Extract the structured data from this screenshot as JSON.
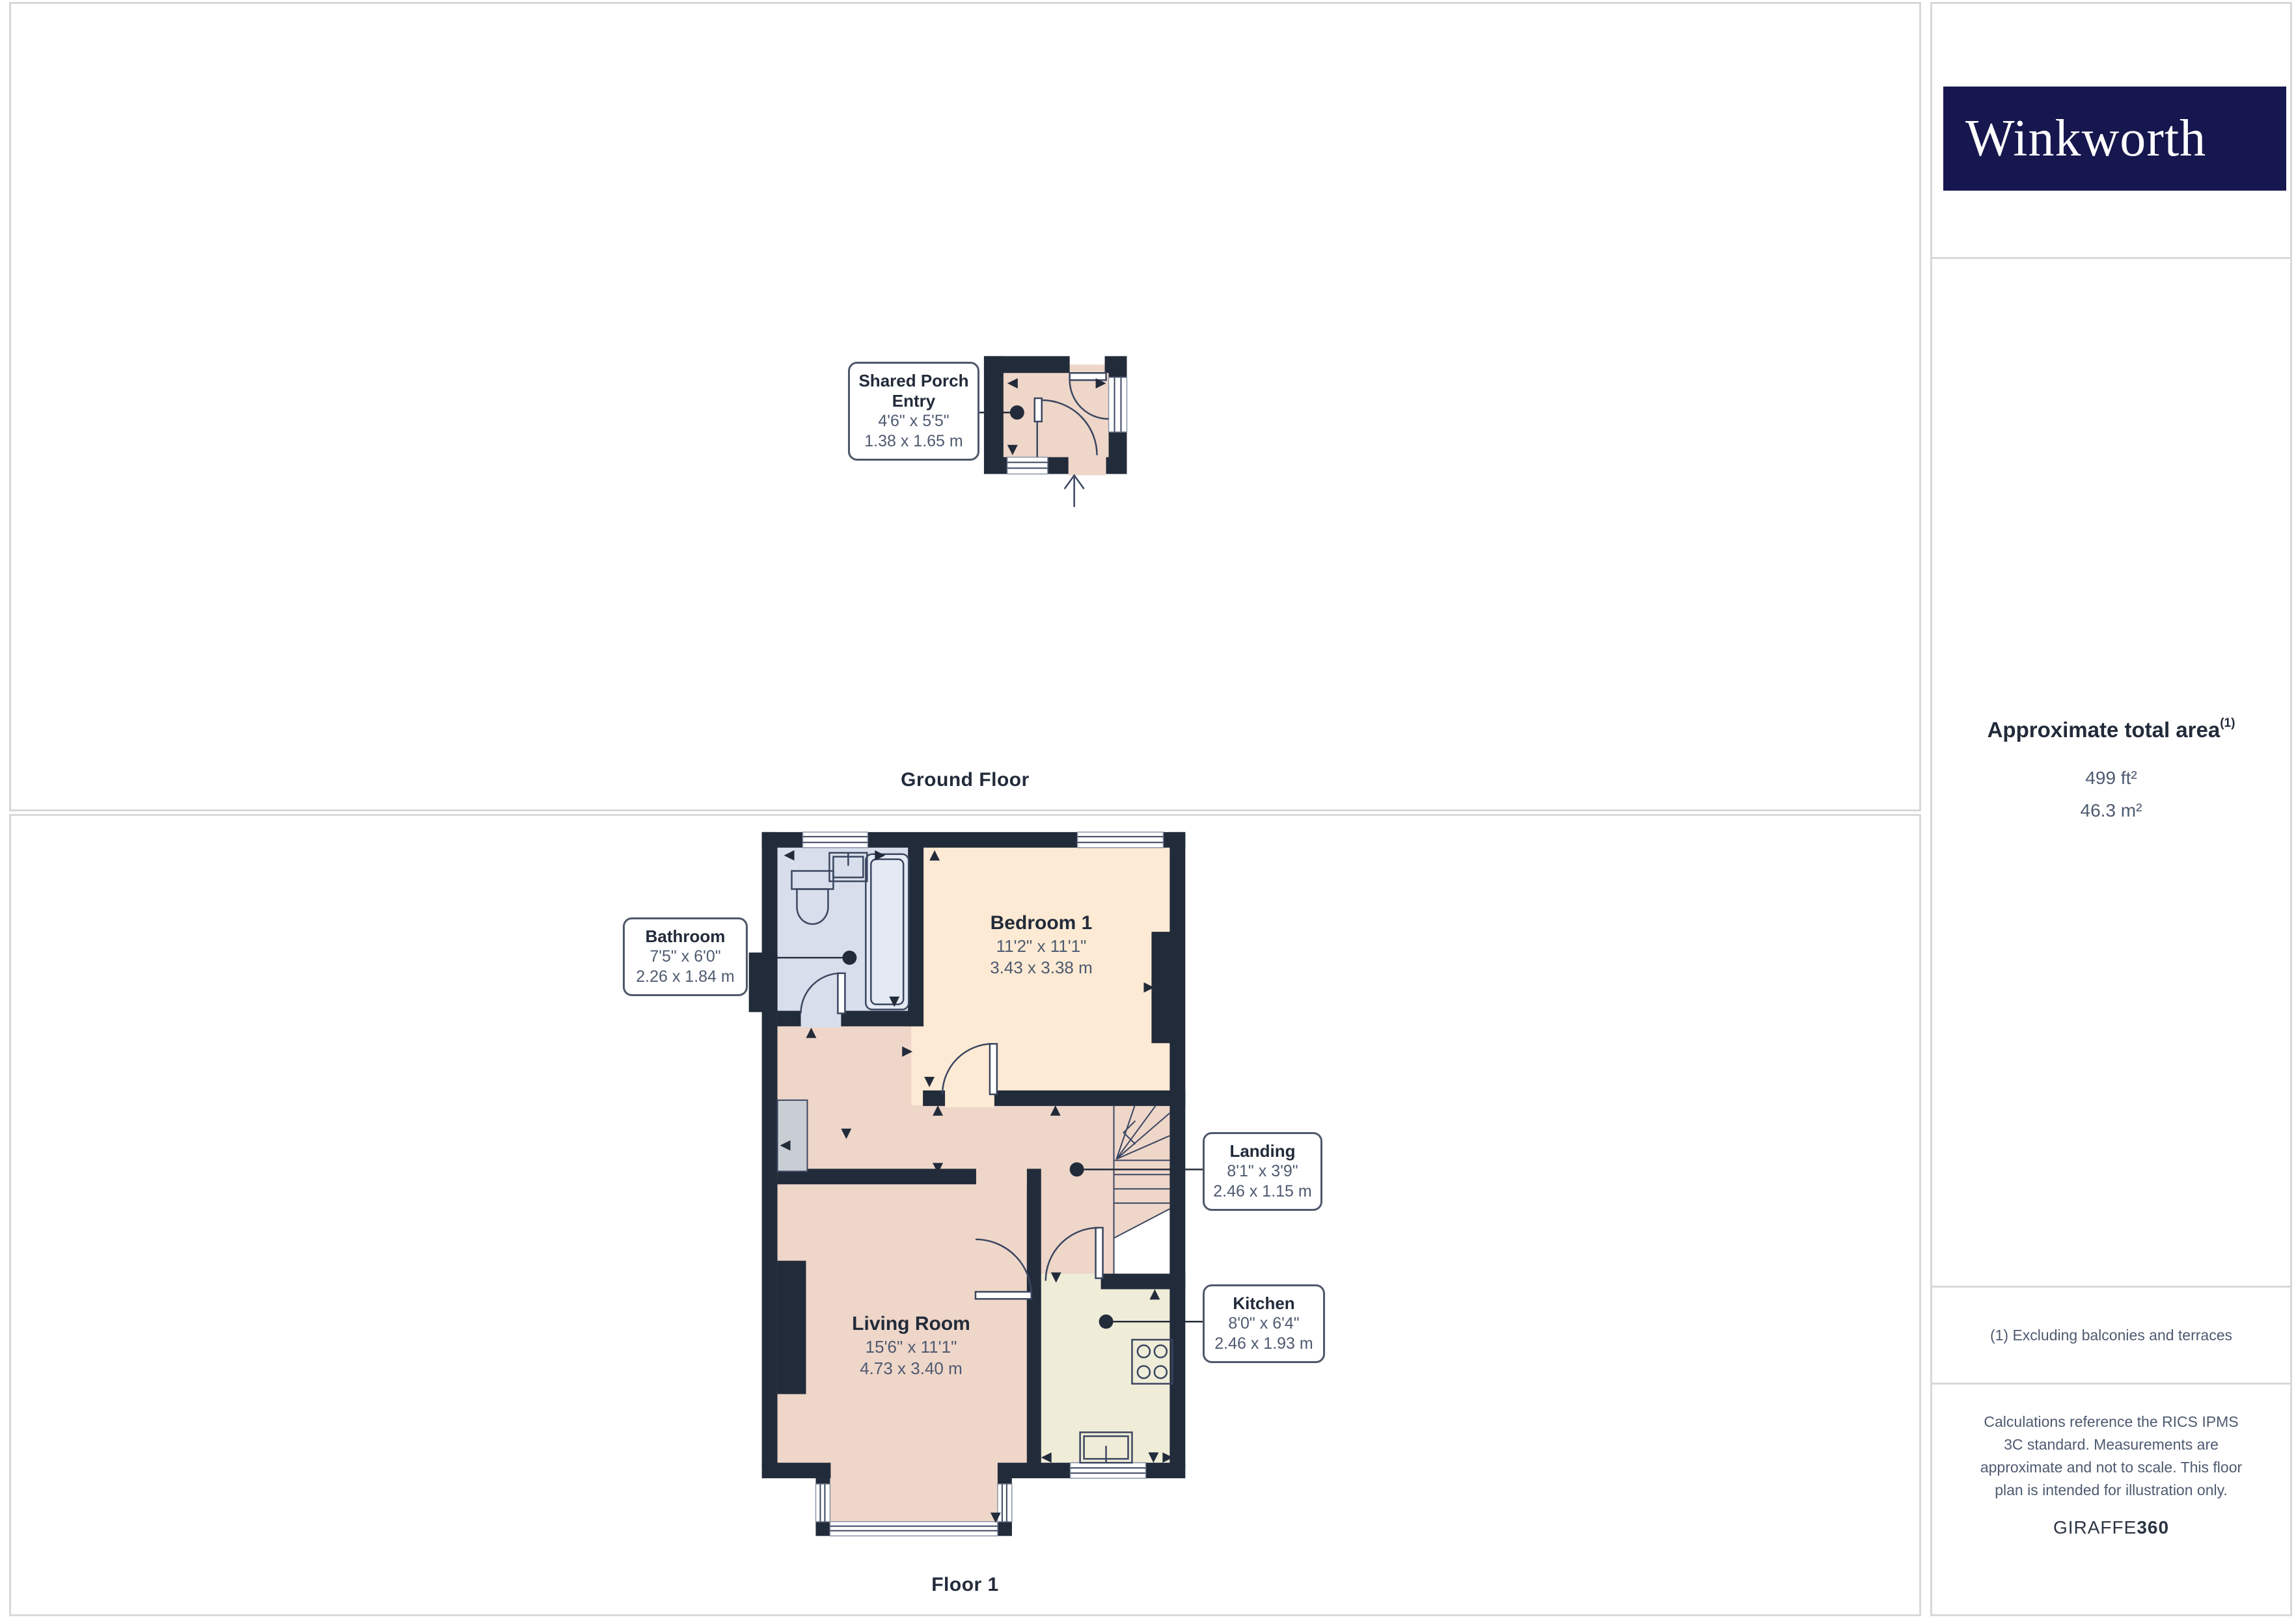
{
  "brand": {
    "name": "Winkworth"
  },
  "panels": {
    "ground": {
      "title": "Ground Floor"
    },
    "first": {
      "title": "Floor 1"
    }
  },
  "rooms": {
    "porch": {
      "name": "Shared Porch Entry",
      "imperial": "4'6\" x 5'5\"",
      "metric": "1.38 x 1.65 m"
    },
    "bathroom": {
      "name": "Bathroom",
      "imperial": "7'5\" x 6'0\"",
      "metric": "2.26 x 1.84 m"
    },
    "bedroom": {
      "name": "Bedroom 1",
      "imperial": "11'2\" x 11'1\"",
      "metric": "3.43 x 3.38 m"
    },
    "landing": {
      "name": "Landing",
      "imperial": "8'1\" x 3'9\"",
      "metric": "2.46 x 1.15 m"
    },
    "living": {
      "name": "Living Room",
      "imperial": "15'6\" x 11'1\"",
      "metric": "4.73 x 3.40 m"
    },
    "kitchen": {
      "name": "Kitchen",
      "imperial": "8'0\" x 6'4\"",
      "metric": "2.46 x 1.93 m"
    }
  },
  "sidebar": {
    "area_title": "Approximate total area",
    "area_footnote_marker": "(1)",
    "area_imperial": "499 ft²",
    "area_metric": "46.3 m²",
    "footnote": "(1) Excluding balconies and terraces",
    "disclaimer": "Calculations reference the RICS IPMS 3C standard. Measurements are approximate and not to scale. This floor plan is intended for illustration only.",
    "credit_brand": "GIRAFFE",
    "credit_suffix": "360"
  },
  "colors": {
    "wall": "#222b3a",
    "line": "#3a4660",
    "floor_tan": "#eed6c9",
    "floor_peach": "#fdead4",
    "floor_bath": "#d8deeb",
    "floor_kitchen": "#efecd8",
    "cabinet_gray": "#c9cdd4",
    "logo_bg": "#17174f",
    "border": "#d8d8d8",
    "text_dark": "#222b3a",
    "text_slate": "#4e5a70"
  }
}
